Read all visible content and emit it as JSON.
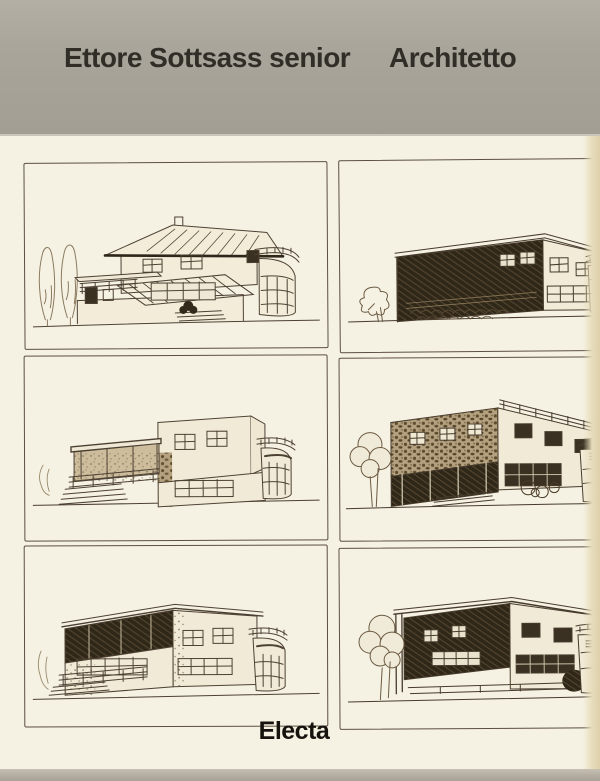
{
  "header": {
    "title_left": "Ettore Sottsass senior",
    "title_right": "Architetto"
  },
  "publisher": {
    "name": "Electa"
  },
  "colors": {
    "header_band": "#a9a59b",
    "paper": "#f5f1e3",
    "ink": "#4d4133",
    "dark_fill": "#2f2819",
    "title_text": "#312e28",
    "publisher_text": "#16130e",
    "page_edge": "#e7dcba",
    "bottom_edge": "#b2aca0"
  },
  "panels": [
    {
      "id": "top-left",
      "subject": "two-storey villa with hipped roof, corner round balcony, veranda railing and two poplar trees"
    },
    {
      "id": "top-right",
      "subject": "flat-roofed modernist house with dark recessed loggia, stone base and round corner balcony"
    },
    {
      "id": "middle-left",
      "subject": "stepped flat-roofed house with long covered porch, side stairs and round balcony"
    },
    {
      "id": "middle-right",
      "subject": "stone-textured flat-roofed house with roof-terrace railing, bushes and round corner balcony"
    },
    {
      "id": "bottom-left",
      "subject": "flat-roofed house with shaded upper loggia, window bands, side stairs and round balcony"
    },
    {
      "id": "bottom-right",
      "subject": "flat-roofed house with open corner frame, large leafy tree and round balcony tower"
    }
  ]
}
